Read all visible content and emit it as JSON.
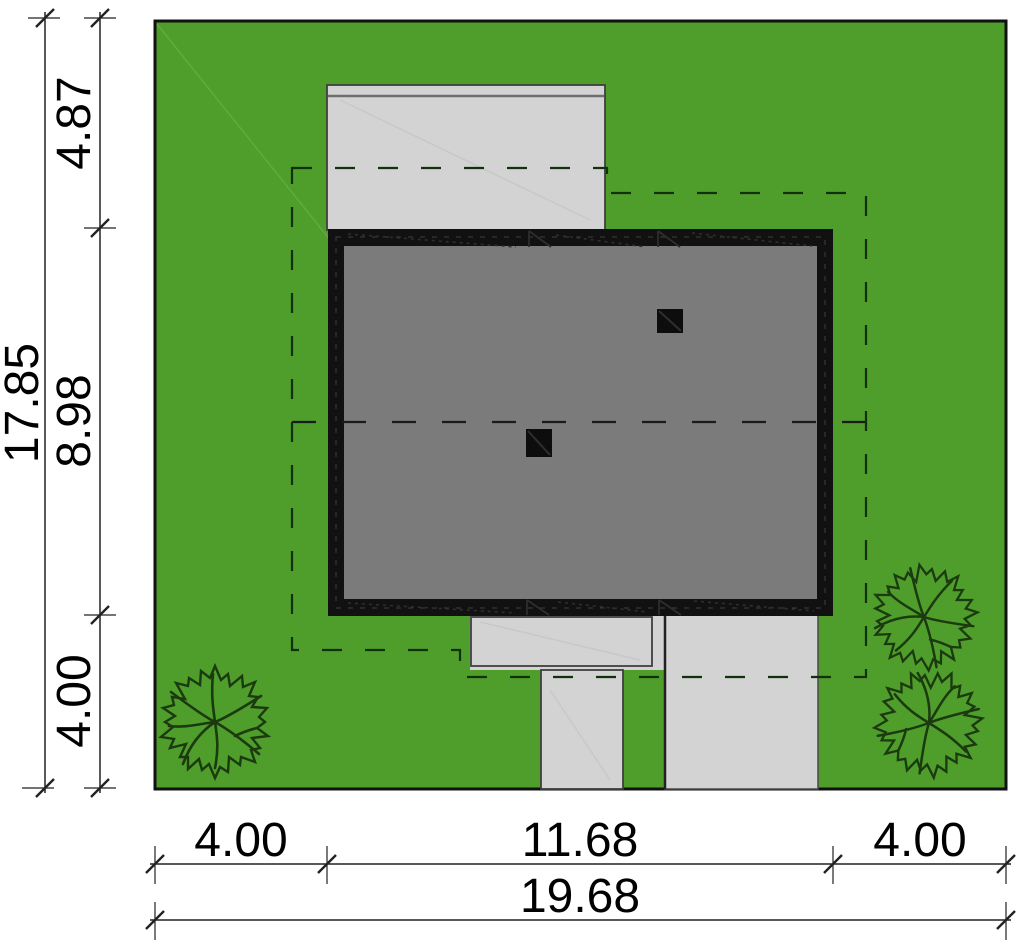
{
  "diagram": {
    "plot": {
      "width_label": "19.68",
      "depth_label": "17.85"
    },
    "dimensions": {
      "left_total": "17.85",
      "left_segments": [
        "4.87",
        "8.98",
        "4.00"
      ],
      "bottom_segments": [
        "4.00",
        "11.68",
        "4.00"
      ],
      "bottom_total": "19.68"
    },
    "colors": {
      "lawn": "#4f9d2b",
      "paving": "#d3d3d3",
      "paving_edge": "#3f3f3f",
      "roof": "#7b7b7b",
      "roof_border": "#111111",
      "plot_border": "#111111",
      "chimney": "#0d0d0d",
      "tree_stroke": "#1b3a10",
      "setback_dash": "#12300b",
      "ridge_dash": "#1a1a1a",
      "dimension_line": "#222222"
    }
  }
}
